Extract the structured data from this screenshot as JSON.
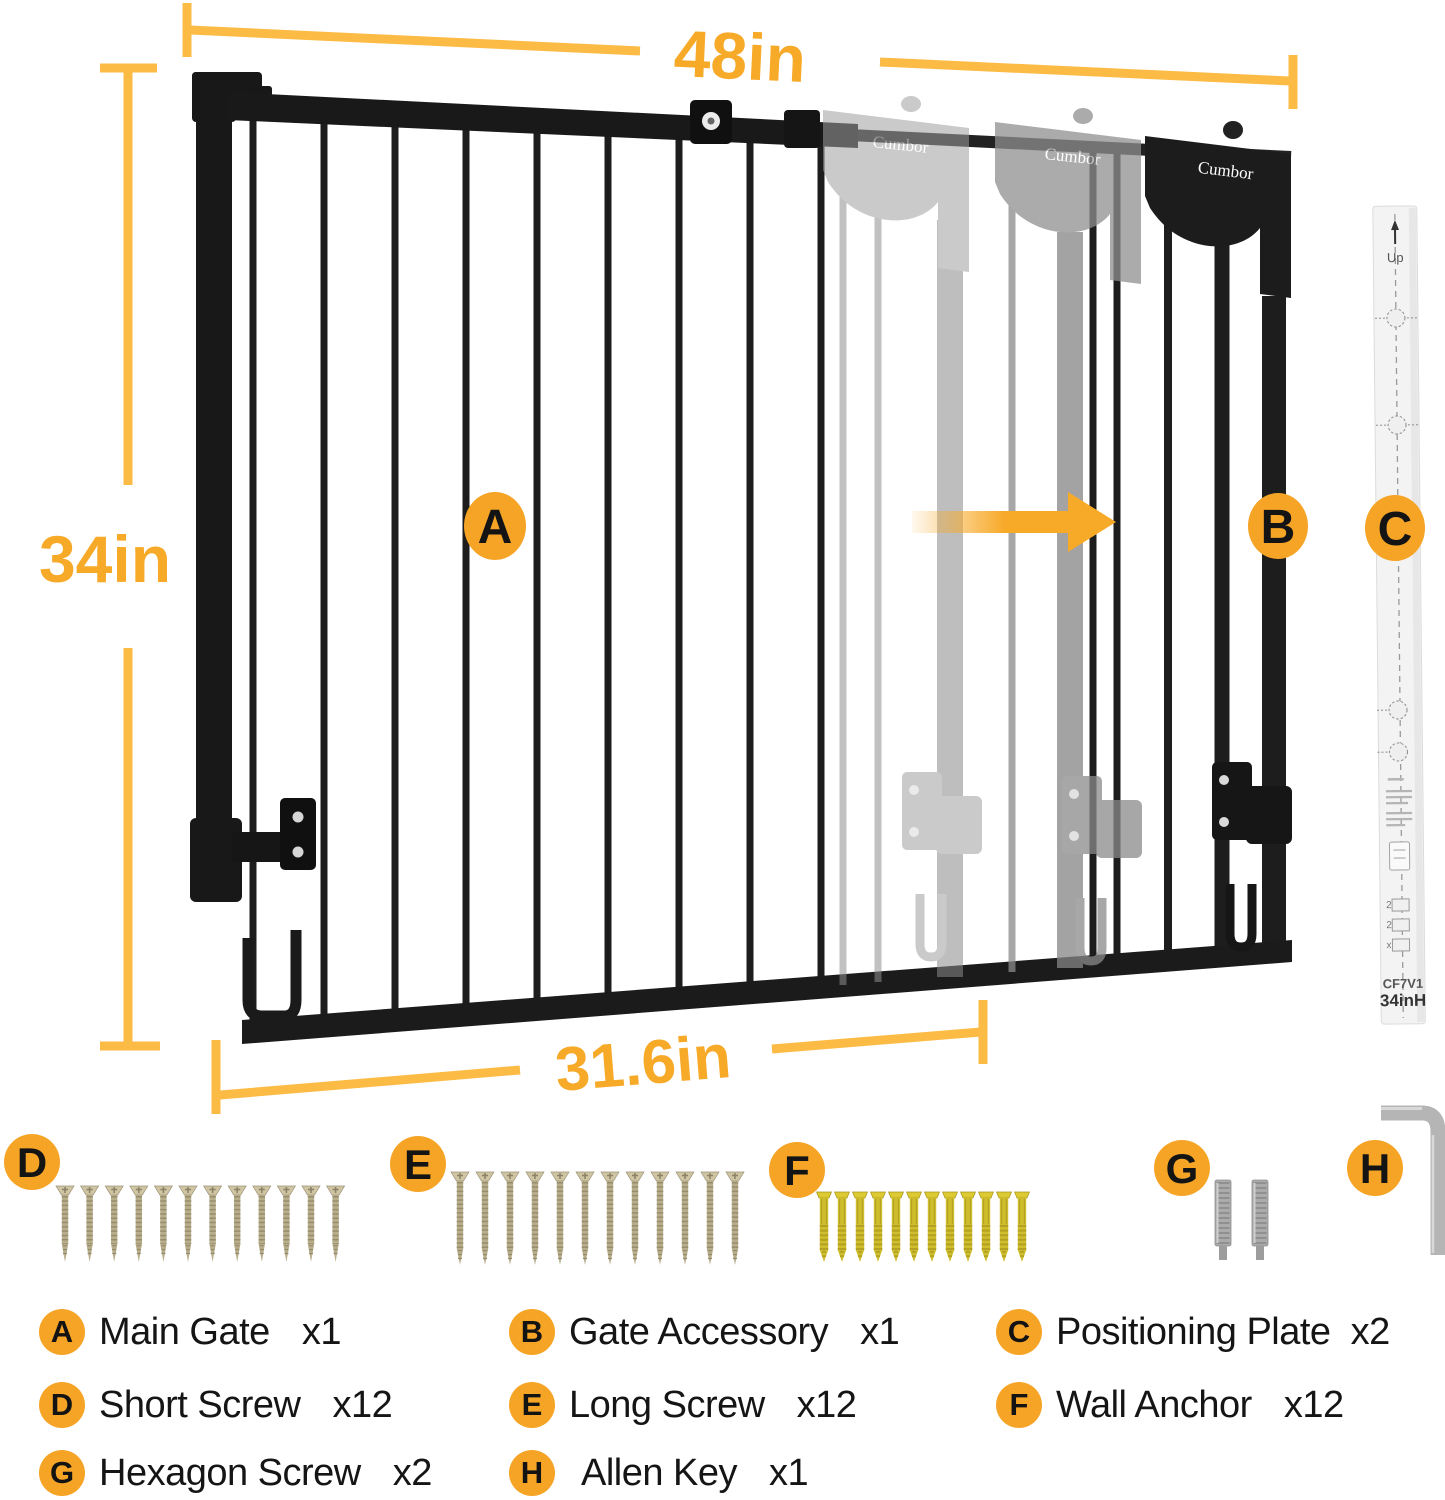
{
  "brand": "Cumbor",
  "colors": {
    "badge": "#F5A426",
    "dim_line": "#FBBB45",
    "dim_text": "#F7A928",
    "gate_black": "#1b1b1b",
    "ghost_gray": "#9a9a9a"
  },
  "dimensions": {
    "total_width": "48in",
    "height": "34in",
    "main_width": "31.6in"
  },
  "callouts": {
    "main_gate": "A",
    "gate_accessory": "B",
    "positioning_plate": "C",
    "short_screw": "D",
    "long_screw": "E",
    "wall_anchor": "F",
    "hexagon_screw": "G",
    "allen_key": "H"
  },
  "plate": {
    "up_label": "Up",
    "model": "CF7V1",
    "height_label": "34inH"
  },
  "hardware": {
    "short_screw": 12,
    "long_screw": 12,
    "wall_anchor": 12,
    "hexagon_screw": 2,
    "allen_key": 1
  },
  "legend": [
    {
      "letter": "A",
      "label": "Main Gate",
      "qty": "x1"
    },
    {
      "letter": "B",
      "label": "Gate Accessory",
      "qty": "x1"
    },
    {
      "letter": "C",
      "label": "Positioning Plate",
      "qty": "x2"
    },
    {
      "letter": "D",
      "label": "Short Screw",
      "qty": "x12"
    },
    {
      "letter": "E",
      "label": "Long Screw",
      "qty": "x12"
    },
    {
      "letter": "F",
      "label": "Wall Anchor",
      "qty": "x12"
    },
    {
      "letter": "G",
      "label": "Hexagon Screw",
      "qty": "x2"
    },
    {
      "letter": "H",
      "label": "Allen Key",
      "qty": "x1"
    }
  ]
}
